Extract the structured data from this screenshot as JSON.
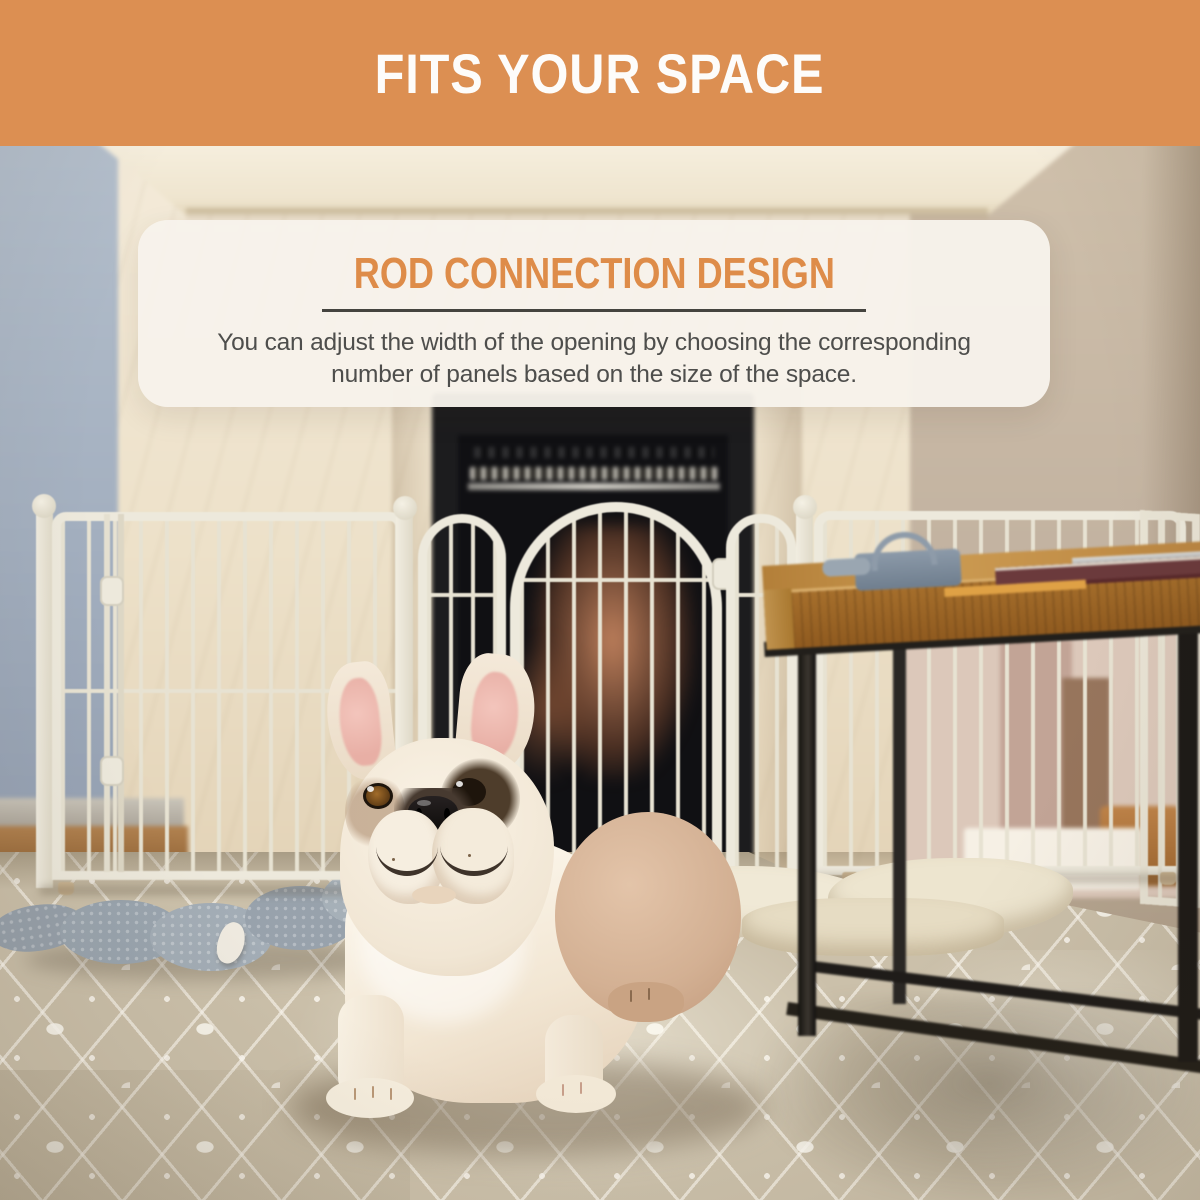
{
  "banner": {
    "title": "FITS YOUR SPACE"
  },
  "card": {
    "heading": "ROD CONNECTION DESIGN",
    "body_line1": "You can adjust the width of the opening by choosing the corresponding",
    "body_line2": "number of panels based on the size of the space."
  },
  "theme": {
    "banner_bg": "#DC8F52",
    "heading_color": "#DE8C49",
    "card_bg": "rgba(247,242,235,0.96)",
    "divider_color": "#45443F",
    "body_text": "#4E4E4C",
    "fence": "#EDE9DC",
    "fence_bar": "#E7E2D2",
    "wood": "#B5783A",
    "wall_left": "#A9B4C2",
    "wall_right": "#C2B2A0",
    "carpet": "#CBC0AA"
  }
}
